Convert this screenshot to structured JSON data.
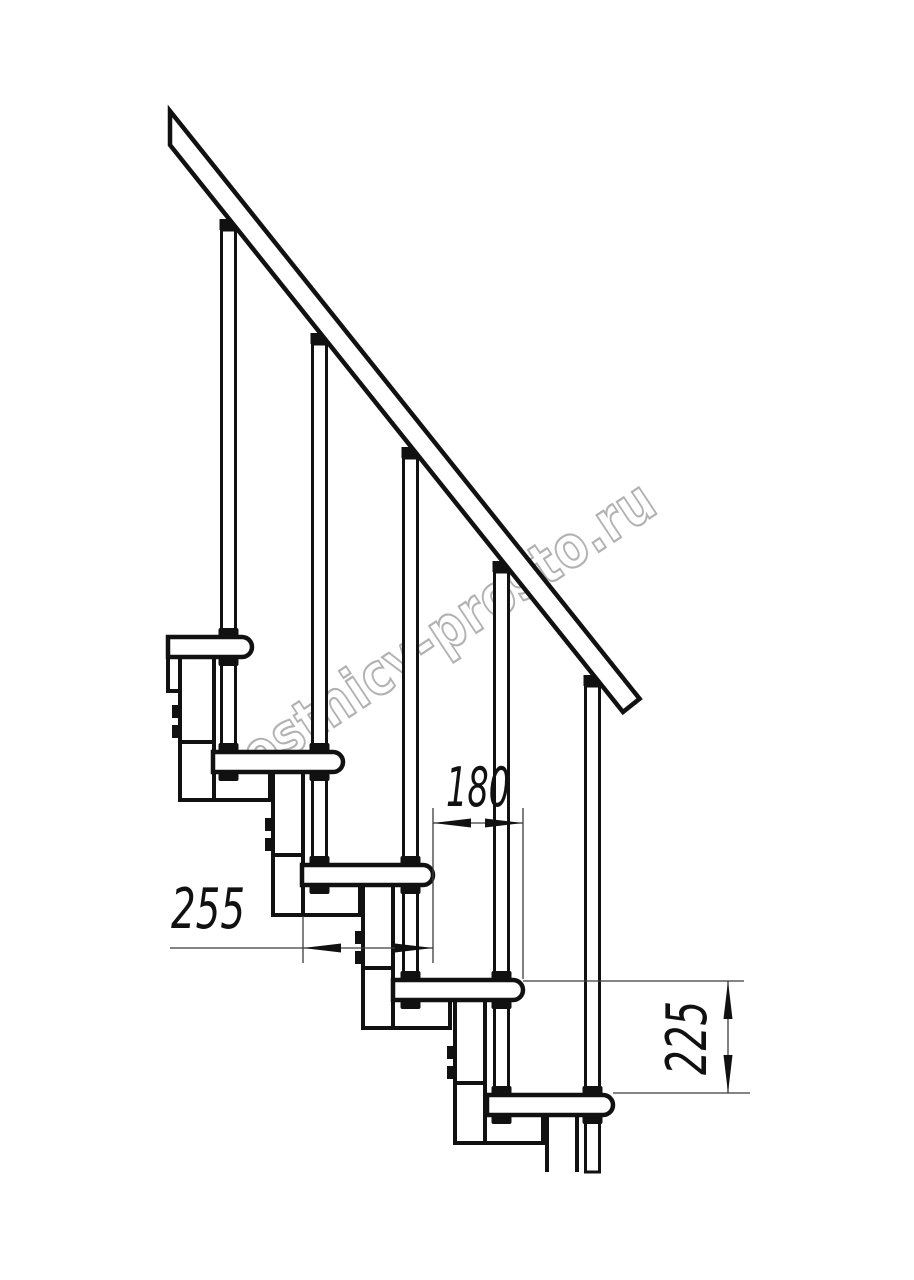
{
  "drawing": {
    "title": "modular-staircase-side-view",
    "watermark": "lestnicy-prosto.ru",
    "dimensions": [
      {
        "id": "tread-depth",
        "value": "255",
        "orientation": "horizontal"
      },
      {
        "id": "going",
        "value": "180",
        "orientation": "horizontal"
      },
      {
        "id": "rise",
        "value": "225",
        "orientation": "vertical"
      }
    ],
    "colors": {
      "line": "#111111",
      "dimension_line": "#3c3c3c",
      "watermark_outline": "#aeaeae",
      "background": "#ffffff"
    },
    "parts": {
      "handrail": 1,
      "baluster_rods": 5,
      "treads": 5,
      "support_modules": 5
    }
  }
}
